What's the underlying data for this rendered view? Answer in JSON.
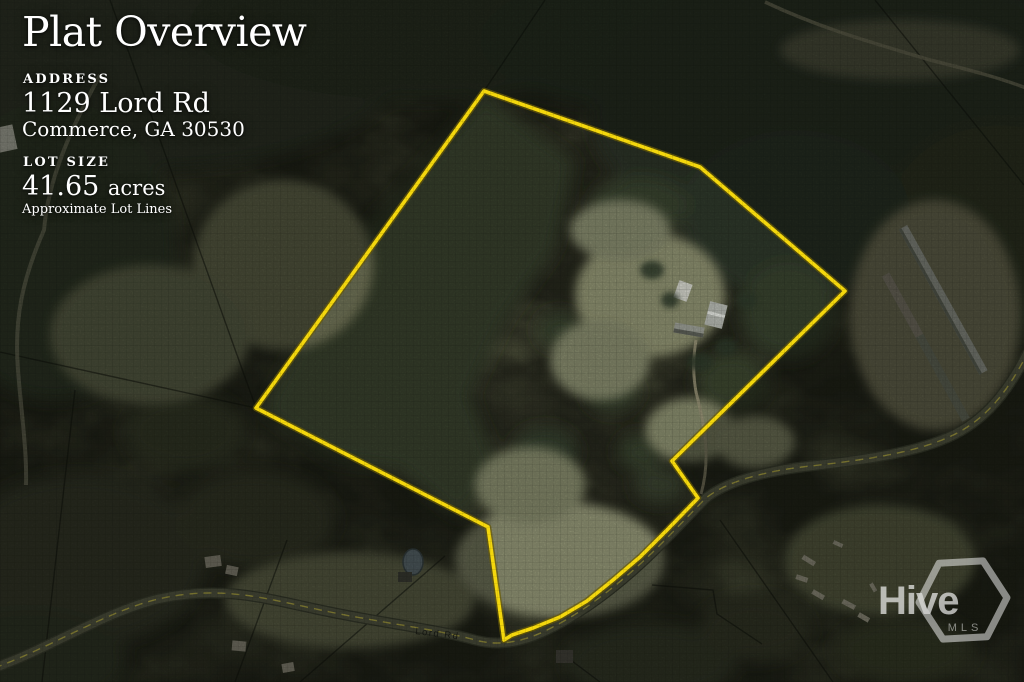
{
  "panel": {
    "title": "Plat Overview",
    "address": {
      "label": "ADDRESS",
      "line1": "1129 Lord Rd",
      "line2": "Commerce, GA 30530"
    },
    "lot": {
      "label": "LOT SIZE",
      "value": "41.65",
      "unit": "acres",
      "note": "Approximate Lot Lines"
    }
  },
  "map": {
    "road_label": "Lord Rd",
    "boundary_color": "#f4d70d",
    "lot_size_acres": 41.65
  },
  "logo": {
    "text": "Hive",
    "subtext": "MLS"
  }
}
